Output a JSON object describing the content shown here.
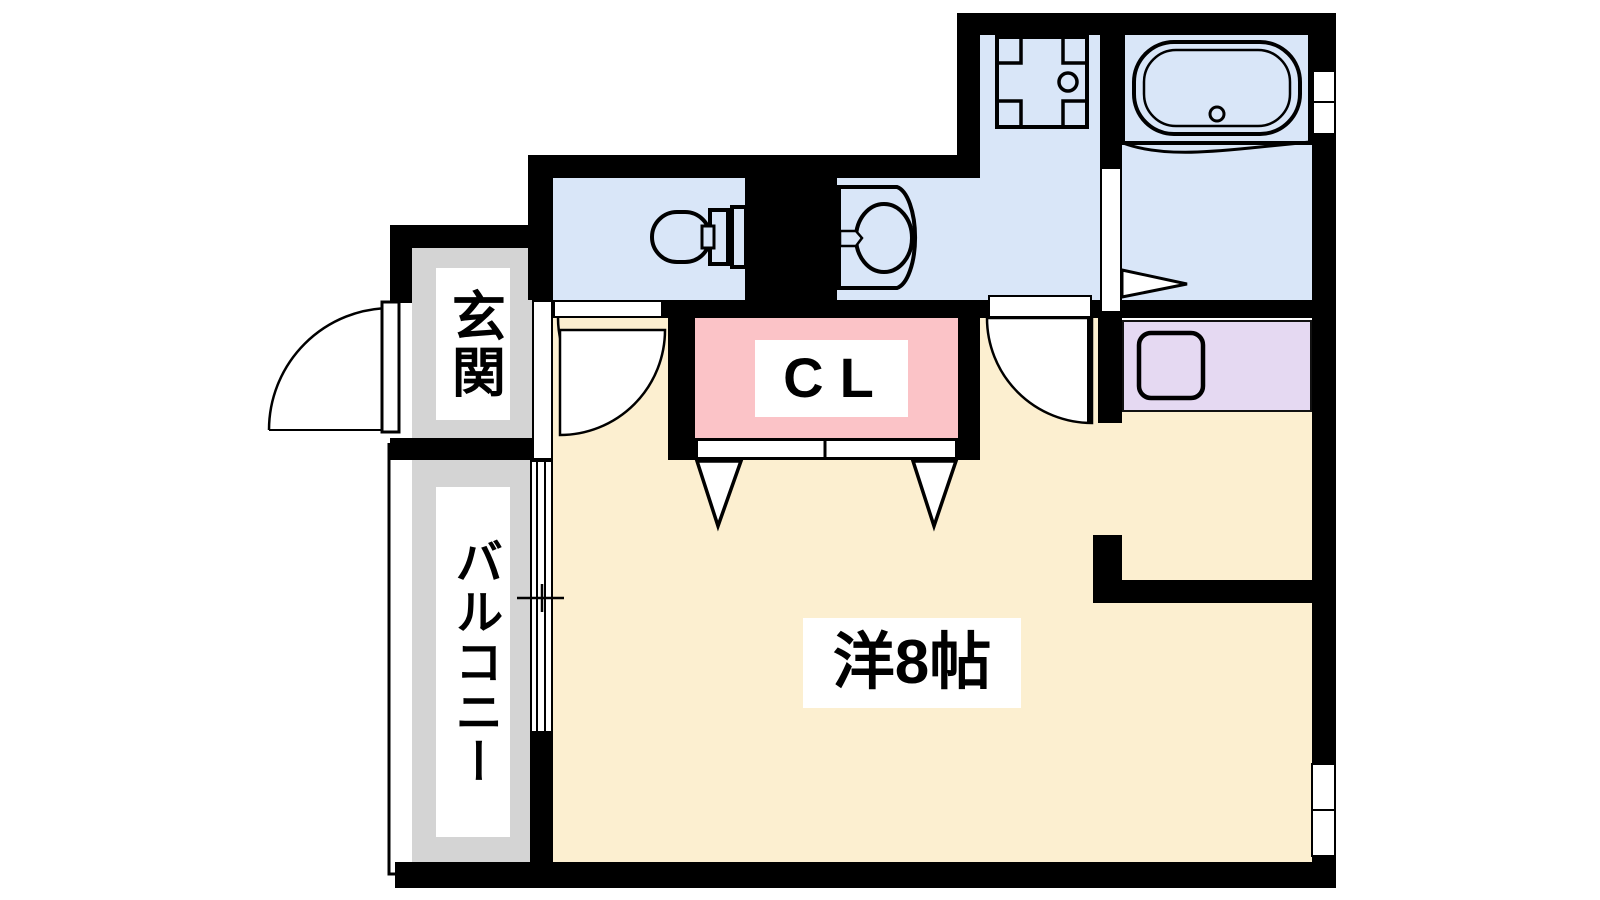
{
  "title": "apartment-floor-plan",
  "labels": {
    "entrance": "玄関",
    "balcony": "バルコニー",
    "closet": "CL",
    "main_room": "洋8帖"
  },
  "rooms": [
    {
      "id": "entrance",
      "label": "玄関",
      "floor_color": "#d4d4d4"
    },
    {
      "id": "balcony",
      "label": "バルコニー",
      "floor_color": "#d4d4d4"
    },
    {
      "id": "closet",
      "label": "CL",
      "floor_color": "#fbc3c7"
    },
    {
      "id": "main-room",
      "label": "洋8帖",
      "floor_color": "#fcefd0"
    },
    {
      "id": "toilet-room",
      "label": "",
      "floor_color": "#d9e6f8"
    },
    {
      "id": "washroom",
      "label": "",
      "floor_color": "#d9e6f8"
    },
    {
      "id": "kitchen",
      "label": "",
      "floor_color": "#d9e6f8"
    },
    {
      "id": "bathroom",
      "label": "",
      "floor_color": "#d9e6f8"
    },
    {
      "id": "utility-nook",
      "label": "",
      "floor_color": "#e5d9f2"
    }
  ],
  "icons": [
    "toilet-icon",
    "washbasin-icon",
    "stove-icon",
    "bathtub-icon",
    "washing-machine-icon",
    "entrance-door-arc-icon",
    "room-door-arc-icon",
    "washroom-door-arc-icon",
    "bath-door-arrow-icon",
    "closet-door-arrow-icon",
    "window-icon",
    "balcony-railing-icon"
  ],
  "colors": {
    "wet": "#d9e6f8",
    "room": "#fcefd0",
    "closet": "#fbc3c7",
    "utility": "#e5d9f2",
    "gray": "#d4d4d4",
    "wall": "#000000",
    "door": "#ffffff"
  }
}
